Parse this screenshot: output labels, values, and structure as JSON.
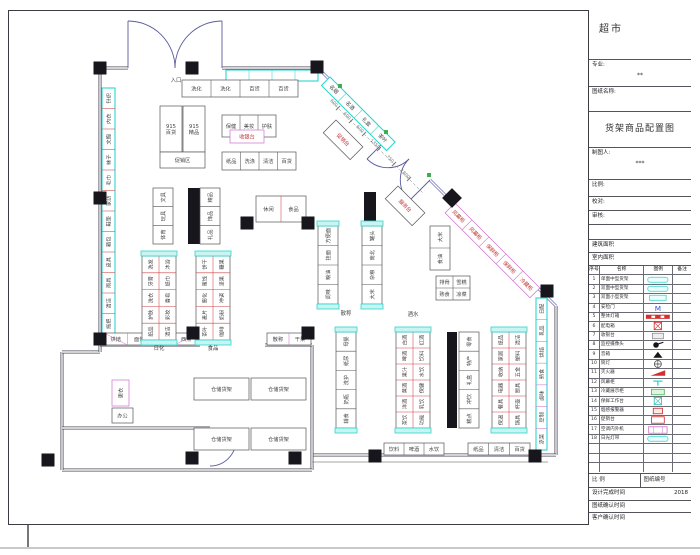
{
  "titleblock": {
    "project": "超市",
    "major_label": "专业:",
    "major_value": "**",
    "drawing_name_label": "图纸名称:",
    "drawing_title": "货架商品配置图",
    "drafter_label": "制图人:",
    "drafter_value": "***",
    "scale_label": "比例:",
    "check_label": "校对:",
    "audit_label": "审核:",
    "area1_label": "建筑面积",
    "area2_label": "室内面积",
    "legend_headers": [
      "序号",
      "名称",
      "图例",
      "备注"
    ],
    "legend_rows": [
      {
        "no": "1",
        "name": "单面中型货架",
        "sym": "pill-cyan"
      },
      {
        "no": "2",
        "name": "双面中型货架",
        "sym": "pill-cyan"
      },
      {
        "no": "3",
        "name": "双面小型货架",
        "sym": "rect-cyan"
      },
      {
        "no": "4",
        "name": "安检门",
        "sym": "m-blue"
      },
      {
        "no": "5",
        "name": "整体灯箱",
        "sym": "bar-red"
      },
      {
        "no": "6",
        "name": "配电箱",
        "sym": "xbox-red"
      },
      {
        "no": "7",
        "name": "收银台",
        "sym": "rect-gray"
      },
      {
        "no": "8",
        "name": "监控摄像头",
        "sym": "cam-black"
      },
      {
        "no": "9",
        "name": "音箱",
        "sym": "tri-black"
      },
      {
        "no": "10",
        "name": "筒灯",
        "sym": "circle-cross"
      },
      {
        "no": "11",
        "name": "灭火器",
        "sym": "flag-red"
      },
      {
        "no": "12",
        "name": "风幕柜",
        "sym": "t-cyan"
      },
      {
        "no": "13",
        "name": "冷藏展示柜",
        "sym": "rect-green"
      },
      {
        "no": "14",
        "name": "保鲜工作台",
        "sym": "xbox-cyan"
      },
      {
        "no": "15",
        "name": "烟感报警器",
        "sym": "rect-red-sm"
      },
      {
        "no": "16",
        "name": "促销台",
        "sym": "rect-red"
      },
      {
        "no": "17",
        "name": "空调内外机",
        "sym": "rect-magenta"
      },
      {
        "no": "18",
        "name": "日光灯带",
        "sym": "pill-cyan"
      },
      {
        "no": "",
        "name": "",
        "sym": "none"
      },
      {
        "no": "",
        "name": "",
        "sym": "none"
      },
      {
        "no": "",
        "name": "",
        "sym": "none"
      }
    ],
    "footer_row1_left": "比 例",
    "footer_row1_right": "图纸编号",
    "footer_row2_label": "设计完成时间",
    "footer_row2_value": "2018",
    "footer_row3_label": "图纸确认时间",
    "footer_row4_label": "客户确认时间"
  },
  "plan": {
    "colors": {
      "wall": "#4a4a55",
      "diag_wall": "#7575b5",
      "cyan": "#2fd6cf",
      "magenta": "#cf6ecf",
      "red": "#cc4444",
      "green": "#3dae54",
      "black": "#16161c",
      "text": "#444",
      "redtext": "#c23434",
      "dim": "#777"
    },
    "walls": [
      "M100,68 L128,68",
      "M222,68 L318,68",
      "M556,306 L556,455",
      "M556,455 L312,455",
      "M312,345 L312,470",
      "M312,470 L62,470",
      "M62,470 L62,352",
      "M62,352 L100,352",
      "M100,352 L100,68",
      "M100,345 L200,345",
      "M265,345 L312,345",
      "M62,428 L210,428",
      "M210,428 L210,440"
    ],
    "diag_walls": [
      "M318,68 L388,138",
      "M430,180 L556,306"
    ],
    "thin_lines": [
      "M312,462 L548,462"
    ],
    "doors": [
      "M128,68 L128,21",
      "M175,68 A47,47 0 0 0 128,21",
      "M222,68 L222,21",
      "M175,68 A47,47 0 0 1 222,21",
      "M388,138 L367,159",
      "M367,159 A29.7,29.7 0 0 0 409,159",
      "M430,180 L409,201",
      "M409,201 A29.7,29.7 0 0 1 409,159",
      "M210,440 L236,440",
      "M210,466 A26,26 0 0 0 236,440"
    ],
    "columns": [
      [
        100,
        68
      ],
      [
        192,
        68
      ],
      [
        317,
        67
      ],
      [
        100,
        198
      ],
      [
        100,
        339
      ],
      [
        247,
        223
      ],
      [
        308,
        223
      ],
      [
        193,
        333
      ],
      [
        308,
        333
      ],
      [
        48,
        460
      ],
      [
        192,
        458
      ],
      [
        295,
        458
      ],
      [
        375,
        456
      ],
      [
        535,
        456
      ],
      [
        547,
        291
      ]
    ],
    "diamond_column": [
      452,
      198
    ],
    "green_markers": [
      [
        386,
        132
      ],
      [
        429,
        175
      ],
      [
        340,
        86
      ]
    ],
    "strips": [
      [
        188,
        188,
        12,
        56
      ],
      [
        364,
        192,
        12,
        30
      ],
      [
        447,
        332,
        10,
        96
      ]
    ],
    "runs": [
      {
        "x": 226,
        "y": 70,
        "w": 92,
        "h": 11,
        "cols": 4,
        "rows": 1,
        "stroke": "cyan",
        "labels": [
          "",
          "",
          "",
          ""
        ]
      },
      {
        "x": 182,
        "y": 80,
        "w": 116,
        "h": 17,
        "cols": 4,
        "rows": 1,
        "labels": [
          "洗化",
          "洗化",
          "百货",
          "百货"
        ]
      },
      {
        "x": 102,
        "y": 88,
        "w": 13,
        "h": 246,
        "cols": 1,
        "rows": 12,
        "stroke": "cyan",
        "div": "red",
        "rot": true,
        "labels": [
          "针织",
          "内衣",
          "文胸",
          "袜子",
          "毛巾",
          "家纺",
          "鞋垫",
          "箱包",
          "皮具",
          "雨具",
          "清洁",
          "拖把"
        ]
      },
      {
        "x": 536,
        "y": 298,
        "w": 11,
        "h": 152,
        "cols": 1,
        "rows": 7,
        "stroke": "cyan",
        "div": "magenta",
        "rot": true,
        "labels": [
          "日配",
          "乳品",
          "烘焙",
          "熟食",
          "卤味",
          "豆制",
          "凉菜"
        ]
      },
      {
        "x": 104,
        "y": 333,
        "w": 94,
        "h": 12,
        "cols": 4,
        "rows": 1,
        "div": "magenta",
        "tris": true,
        "labels": [
          "烘焙",
          "面包",
          "蛋糕",
          "西点"
        ]
      },
      {
        "x": 267,
        "y": 333,
        "w": 44,
        "h": 12,
        "cols": 2,
        "rows": 1,
        "div": "magenta",
        "labels": [
          "散称",
          "干果"
        ]
      },
      {
        "x": 384,
        "y": 443,
        "w": 60,
        "h": 12,
        "cols": 3,
        "rows": 1,
        "labels": [
          "饮料",
          "啤酒",
          "水饮"
        ]
      },
      {
        "x": 468,
        "y": 443,
        "w": 62,
        "h": 12,
        "cols": 3,
        "rows": 1,
        "labels": [
          "纸品",
          "清洁",
          "百货"
        ]
      },
      {
        "x": 330,
        "y": 77,
        "w": 92,
        "h": 12,
        "cols": 4,
        "rows": 1,
        "grot": 45,
        "stroke": "cyan",
        "labels": [
          "名烟",
          "名酒",
          "礼盒",
          "茶叶"
        ]
      },
      {
        "x": 455,
        "y": 203,
        "w": 120,
        "h": 14,
        "cols": 5,
        "rows": 1,
        "grot": 45,
        "stroke": "magenta",
        "tc": "redtext",
        "labels": [
          "风幕柜",
          "风幕柜",
          "保鲜柜",
          "保鲜柜",
          "冷藏柜"
        ]
      },
      {
        "x": 222,
        "y": 115,
        "w": 54,
        "h": 22,
        "cols": 3,
        "rows": 1,
        "labels": [
          "保健",
          "美妆",
          "护肤"
        ]
      },
      {
        "x": 222,
        "y": 152,
        "w": 74,
        "h": 18,
        "cols": 4,
        "rows": 1,
        "labels": [
          "纸品",
          "洗涤",
          "清洁",
          "百货"
        ]
      },
      {
        "x": 160,
        "y": 106,
        "w": 22,
        "h": 46,
        "cols": 1,
        "rows": 1,
        "labels": [
          "915|百货"
        ]
      },
      {
        "x": 183,
        "y": 106,
        "w": 22,
        "h": 46,
        "cols": 1,
        "rows": 1,
        "labels": [
          "915|精品"
        ]
      },
      {
        "x": 160,
        "y": 152,
        "w": 45,
        "h": 16,
        "cols": 1,
        "rows": 1,
        "labels": [
          "促销区"
        ]
      },
      {
        "x": 153,
        "y": 188,
        "w": 20,
        "h": 56,
        "cols": 1,
        "rows": 3,
        "rot": true,
        "labels": [
          "文具",
          "玩具",
          "体育"
        ]
      },
      {
        "x": 200,
        "y": 188,
        "w": 20,
        "h": 56,
        "cols": 1,
        "rows": 3,
        "rot": true,
        "labels": [
          "精品",
          "饰品",
          "礼品"
        ]
      },
      {
        "x": 256,
        "y": 196,
        "w": 50,
        "h": 26,
        "cols": 2,
        "rows": 1,
        "div": "red",
        "labels": [
          "休闲",
          "食品"
        ]
      },
      {
        "x": 142,
        "y": 256,
        "w": 34,
        "h": 84,
        "cols": 2,
        "rows": 5,
        "div": "red",
        "caps": true,
        "rot": true,
        "labels": [
          "洗发",
          "沐浴",
          "牙膏",
          "纸巾",
          "洗衣",
          "香皂",
          "护肤",
          "彩妆",
          "纸品",
          "清洁"
        ]
      },
      {
        "x": 196,
        "y": 256,
        "w": 34,
        "h": 84,
        "cols": 2,
        "rows": 5,
        "div": "red",
        "caps": true,
        "rot": true,
        "labels": [
          "饼干",
          "糖果",
          "蜜饯",
          "坚果",
          "膨化",
          "冲调",
          "麦片",
          "奶粉",
          "茶叶",
          "咖啡"
        ]
      },
      {
        "x": 318,
        "y": 226,
        "w": 20,
        "h": 78,
        "cols": 1,
        "rows": 4,
        "caps": true,
        "rot": true,
        "labels": [
          "方便面",
          "挂面",
          "粮油",
          "调味"
        ]
      },
      {
        "x": 362,
        "y": 226,
        "w": 20,
        "h": 78,
        "cols": 1,
        "rows": 4,
        "caps": true,
        "rot": true,
        "labels": [
          "罐头",
          "南北",
          "杂粮",
          "大米"
        ]
      },
      {
        "x": 430,
        "y": 226,
        "w": 20,
        "h": 44,
        "cols": 1,
        "rows": 2,
        "rot": true,
        "labels": [
          "大米",
          "食油"
        ]
      },
      {
        "x": 436,
        "y": 276,
        "w": 34,
        "h": 24,
        "cols": 2,
        "rows": 2,
        "labels": [
          "排骨",
          "雪糕",
          "熟食",
          "凉菜"
        ]
      },
      {
        "x": 336,
        "y": 332,
        "w": 20,
        "h": 96,
        "cols": 1,
        "rows": 5,
        "caps": true,
        "rot": true,
        "labels": [
          "母婴",
          "纸尿",
          "洗护",
          "奶瓶",
          "辅食"
        ]
      },
      {
        "x": 396,
        "y": 332,
        "w": 34,
        "h": 96,
        "cols": 2,
        "rows": 6,
        "div": "red",
        "caps": true,
        "rot": true,
        "labels": [
          "白酒",
          "红酒",
          "啤酒",
          "饮料",
          "果汁",
          "水饮",
          "黄酒",
          "保健",
          "洋酒",
          "乳饮",
          "茶饮",
          "功能"
        ]
      },
      {
        "x": 459,
        "y": 332,
        "w": 20,
        "h": 96,
        "cols": 1,
        "rows": 5,
        "rot": true,
        "labels": [
          "零食",
          "特产",
          "礼盒",
          "冲饮",
          "糕点"
        ]
      },
      {
        "x": 492,
        "y": 332,
        "w": 34,
        "h": 96,
        "cols": 2,
        "rows": 6,
        "div": "red",
        "caps": true,
        "rot": true,
        "labels": [
          "纸品",
          "清洁",
          "家居",
          "塑料",
          "收纳",
          "五金",
          "电器",
          "厨具",
          "餐具",
          "杯壶",
          "保温",
          "锅具"
        ]
      },
      {
        "x": 194,
        "y": 378,
        "w": 55,
        "h": 22,
        "cols": 1,
        "rows": 1,
        "labels": [
          "仓储货架"
        ]
      },
      {
        "x": 251,
        "y": 378,
        "w": 55,
        "h": 22,
        "cols": 1,
        "rows": 1,
        "labels": [
          "仓储货架"
        ]
      },
      {
        "x": 194,
        "y": 428,
        "w": 55,
        "h": 22,
        "cols": 1,
        "rows": 1,
        "labels": [
          "仓储货架"
        ]
      },
      {
        "x": 251,
        "y": 428,
        "w": 55,
        "h": 22,
        "cols": 1,
        "rows": 1,
        "labels": [
          "仓储货架"
        ]
      },
      {
        "x": 112,
        "y": 380,
        "w": 17,
        "h": 26,
        "cols": 1,
        "rows": 1,
        "stroke": "magenta",
        "rot": true,
        "labels": [
          "更衣"
        ]
      },
      {
        "x": 112,
        "y": 408,
        "w": 21,
        "h": 15,
        "cols": 1,
        "rows": 1,
        "labels": [
          "办公"
        ]
      },
      {
        "x": 336,
        "y": 120,
        "w": 38,
        "h": 18,
        "cols": 1,
        "rows": 1,
        "grot": 45,
        "tc": "redtext",
        "labels": [
          "促销台"
        ]
      },
      {
        "x": 398,
        "y": 186,
        "w": 38,
        "h": 18,
        "cols": 1,
        "rows": 1,
        "grot": 45,
        "tc": "redtext",
        "labels": [
          "服务台"
        ]
      },
      {
        "x": 230,
        "y": 130,
        "w": 34,
        "h": 13,
        "cols": 1,
        "rows": 1,
        "stroke": "magenta",
        "tc": "redtext",
        "labels": [
          "收银台"
        ]
      }
    ],
    "texts": [
      {
        "x": 176,
        "y": 82,
        "t": "入口"
      },
      {
        "x": 159,
        "y": 350,
        "t": "日化"
      },
      {
        "x": 213,
        "y": 350,
        "t": "食品"
      },
      {
        "x": 346,
        "y": 315,
        "t": "散称"
      },
      {
        "x": 413,
        "y": 316,
        "t": "酒水"
      }
    ],
    "dims": {
      "guide": "M332,102 L424,194",
      "points": [
        [
          338,
          108
        ],
        [
          351,
          121
        ],
        [
          364,
          134
        ],
        [
          379,
          149
        ],
        [
          394,
          164
        ],
        [
          409,
          179
        ]
      ],
      "labels": [
        "600",
        "600",
        "600",
        "1350",
        "750",
        "1800"
      ]
    }
  }
}
